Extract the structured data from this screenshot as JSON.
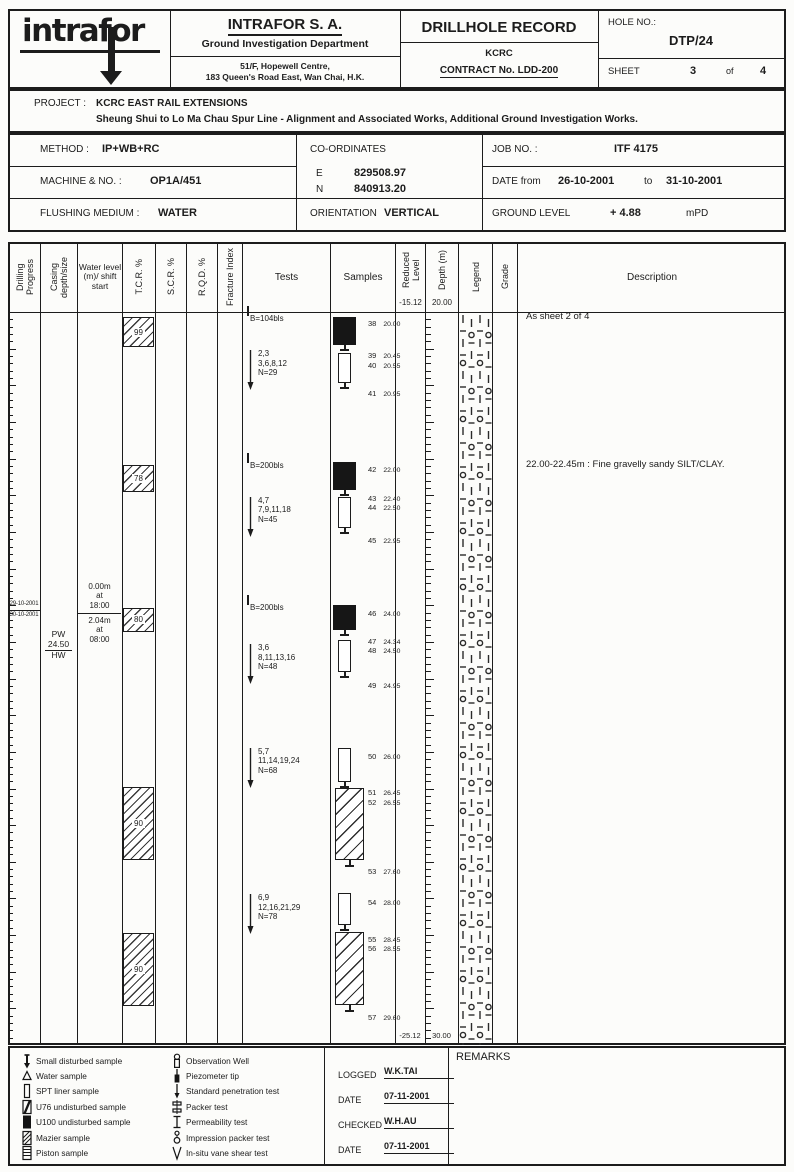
{
  "header": {
    "logo_text": "intrafor",
    "company_name": "INTRAFOR S. A.",
    "department": "Ground Investigation Department",
    "address_line1": "51/F, Hopewell Centre,",
    "address_line2": "183 Queen's Road East, Wan Chai, H.K.",
    "record_title": "DRILLHOLE RECORD",
    "client": "KCRC",
    "contract": "CONTRACT No. LDD-200",
    "hole_no_label": "HOLE NO.:",
    "hole_no": "DTP/24",
    "sheet_label": "SHEET",
    "sheet_no": "3",
    "sheet_of_label": "of",
    "sheet_total": "4"
  },
  "project": {
    "label": "PROJECT :",
    "name": "KCRC EAST RAIL EXTENSIONS",
    "subtitle": "Sheung Shui to Lo Ma Chau Spur Line - Alignment and Associated Works, Additional Ground Investigation Works."
  },
  "info": {
    "method_label": "METHOD :",
    "method": "IP+WB+RC",
    "coordinates_label": "CO-ORDINATES",
    "easting_label": "E",
    "easting": "829508.97",
    "northing_label": "N",
    "northing": "840913.20",
    "job_label": "JOB NO. :",
    "job_no": "ITF 4175",
    "machine_label": "MACHINE & NO. :",
    "machine": "OP1A/451",
    "date_label": "DATE  from",
    "date_from": "26-10-2001",
    "date_to_label": "to",
    "date_to": "31-10-2001",
    "flushing_label": "FLUSHING MEDIUM :",
    "flushing": "WATER",
    "orientation_label": "ORIENTATION",
    "orientation": "VERTICAL",
    "ground_label": "GROUND LEVEL",
    "ground_level": "+ 4.88",
    "ground_unit": "mPD"
  },
  "log": {
    "columns": [
      {
        "key": "drilling-progress",
        "label": "Drilling Progress",
        "rotated": true
      },
      {
        "key": "casing",
        "label": "Casing depth/size",
        "rotated": true
      },
      {
        "key": "water-level",
        "label": "Water level (m)/ shift start",
        "rotated": false,
        "small": true
      },
      {
        "key": "tcr",
        "label": "T.C.R. %",
        "rotated": true
      },
      {
        "key": "scr",
        "label": "S.C.R. %",
        "rotated": true
      },
      {
        "key": "rqd",
        "label": "R.Q.D. %",
        "rotated": true
      },
      {
        "key": "fracture-index",
        "label": "Fracture Index",
        "rotated": true
      },
      {
        "key": "tests",
        "label": "Tests",
        "rotated": false
      },
      {
        "key": "samples",
        "label": "Samples",
        "rotated": false
      },
      {
        "key": "reduced-level",
        "label": "Reduced Level",
        "rotated": true,
        "sub": "-15.12"
      },
      {
        "key": "depth",
        "label": "Depth (m)",
        "rotated": true,
        "sub": "20.00"
      },
      {
        "key": "legend",
        "label": "Legend",
        "rotated": true
      },
      {
        "key": "grade",
        "label": "Grade",
        "rotated": true
      },
      {
        "key": "description",
        "label": "Description",
        "rotated": false
      }
    ],
    "depth_range": [
      20.0,
      30.0
    ],
    "top_reduced_level": "-15.12",
    "top_depth": "20.00",
    "bottom_reduced_level": "-25.12",
    "bottom_depth": "30.00",
    "drilling_progress": {
      "date_above": "29-10-2001",
      "date_below": "30-10-2001",
      "boundary_depth": 24.07
    },
    "casing": {
      "size_label": "PW",
      "depth_value": "24.50",
      "size_below": "HW",
      "at_depth": 24.32
    },
    "water_levels": {
      "above": [
        "0.00m",
        "at",
        "18:00"
      ],
      "below": [
        "2.04m",
        "at",
        "08:00"
      ],
      "boundary_depth": 24.1
    },
    "tcr_boxes": [
      {
        "value": "99",
        "from": 20.07,
        "to": 20.48
      },
      {
        "value": "78",
        "from": 22.09,
        "to": 22.46
      },
      {
        "value": "80",
        "from": 24.04,
        "to": 24.36
      },
      {
        "value": "90",
        "from": 26.48,
        "to": 27.48
      },
      {
        "value": "90",
        "from": 28.47,
        "to": 29.47
      }
    ],
    "tests": [
      {
        "type": "driving",
        "label": "B=104bls",
        "depth": 20.08
      },
      {
        "type": "spt",
        "lines": [
          "2,3",
          "3,6,8,12",
          "N=29"
        ],
        "depth": 20.55
      },
      {
        "type": "driving",
        "label": "B=200bls",
        "depth": 22.09
      },
      {
        "type": "spt",
        "lines": [
          "4,7",
          "7,9,11,18",
          "N=45"
        ],
        "depth": 22.55
      },
      {
        "type": "driving",
        "label": "B=200bls",
        "depth": 24.02
      },
      {
        "type": "spt",
        "lines": [
          "3,6",
          "8,11,13,16",
          "N=48"
        ],
        "depth": 24.56
      },
      {
        "type": "spt",
        "lines": [
          "5,7",
          "11,14,19,24",
          "N=68"
        ],
        "depth": 25.97
      },
      {
        "type": "spt",
        "lines": [
          "6,9",
          "12,16,21,29",
          "N=78"
        ],
        "depth": 27.97
      }
    ],
    "sample_boxes": [
      {
        "type": "u100",
        "from": 20.07,
        "to": 20.45
      },
      {
        "type": "spt",
        "from": 20.56,
        "to": 20.97
      },
      {
        "type": "u100",
        "from": 22.05,
        "to": 22.43
      },
      {
        "type": "spt",
        "from": 22.52,
        "to": 22.95
      },
      {
        "type": "u100",
        "from": 24.0,
        "to": 24.34
      },
      {
        "type": "spt",
        "from": 24.47,
        "to": 24.91
      },
      {
        "type": "spt",
        "from": 25.95,
        "to": 26.41
      },
      {
        "type": "mazier",
        "from": 26.49,
        "to": 27.48
      },
      {
        "type": "spt",
        "from": 27.93,
        "to": 28.36
      },
      {
        "type": "mazier",
        "from": 28.46,
        "to": 29.45
      }
    ],
    "sample_labels": [
      {
        "no": "38",
        "value": "20.00",
        "depth": 20.07
      },
      {
        "no": "39",
        "value": "20.45",
        "depth": 20.5
      },
      {
        "no": "40",
        "value": "20.55",
        "depth": 20.64
      },
      {
        "no": "41",
        "value": "20.95",
        "depth": 21.02
      },
      {
        "no": "42",
        "value": "22.00",
        "depth": 22.06
      },
      {
        "no": "43",
        "value": "22.40",
        "depth": 22.46
      },
      {
        "no": "44",
        "value": "22.50",
        "depth": 22.58
      },
      {
        "no": "45",
        "value": "22.95",
        "depth": 23.03
      },
      {
        "no": "46",
        "value": "24.00",
        "depth": 24.02
      },
      {
        "no": "47",
        "value": "24.34",
        "depth": 24.4
      },
      {
        "no": "48",
        "value": "24.50",
        "depth": 24.53
      },
      {
        "no": "49",
        "value": "24.95",
        "depth": 25.0
      },
      {
        "no": "50",
        "value": "26.00",
        "depth": 25.97
      },
      {
        "no": "51",
        "value": "26.45",
        "depth": 26.47
      },
      {
        "no": "52",
        "value": "26.55",
        "depth": 26.6
      },
      {
        "no": "53",
        "value": "27.60",
        "depth": 27.54
      },
      {
        "no": "54",
        "value": "28.00",
        "depth": 27.96
      },
      {
        "no": "55",
        "value": "28.45",
        "depth": 28.47
      },
      {
        "no": "56",
        "value": "28.55",
        "depth": 28.6
      },
      {
        "no": "57",
        "value": "29.60",
        "depth": 29.53
      }
    ],
    "descriptions": [
      {
        "text": "As sheet 2 of 4",
        "depth": 20.04
      },
      {
        "text": "22.00-22.45m : Fine gravelly sandy SILT/CLAY.",
        "depth": 22.06
      }
    ]
  },
  "footer": {
    "samples_key": [
      {
        "symbol": "small-disturbed",
        "label": "Small disturbed sample"
      },
      {
        "symbol": "water",
        "label": "Water sample"
      },
      {
        "symbol": "spt-liner",
        "label": "SPT liner sample"
      },
      {
        "symbol": "u76",
        "label": "U76 undisturbed sample"
      },
      {
        "symbol": "u100",
        "label": "U100 undisturbed sample"
      },
      {
        "symbol": "mazier",
        "label": "Mazier sample"
      },
      {
        "symbol": "piston",
        "label": "Piston sample"
      }
    ],
    "tests_key": [
      {
        "symbol": "observation-well",
        "label": "Observation Well"
      },
      {
        "symbol": "piezometer-tip",
        "label": "Piezometer tip"
      },
      {
        "symbol": "spt-arrow",
        "label": "Standard penetration test"
      },
      {
        "symbol": "packer",
        "label": "Packer test"
      },
      {
        "symbol": "permeability",
        "label": "Permeability test"
      },
      {
        "symbol": "impression-packer",
        "label": "Impression packer test"
      },
      {
        "symbol": "vane-shear",
        "label": "In-situ vane shear test"
      }
    ],
    "remarks_label": "REMARKS",
    "signoff": {
      "logged_label": "LOGGED",
      "logged": "W.K.TAI",
      "date1_label": "DATE",
      "date1": "07-11-2001",
      "checked_label": "CHECKED",
      "checked": "W.H.AU",
      "date2_label": "DATE",
      "date2": "07-11-2001"
    }
  }
}
